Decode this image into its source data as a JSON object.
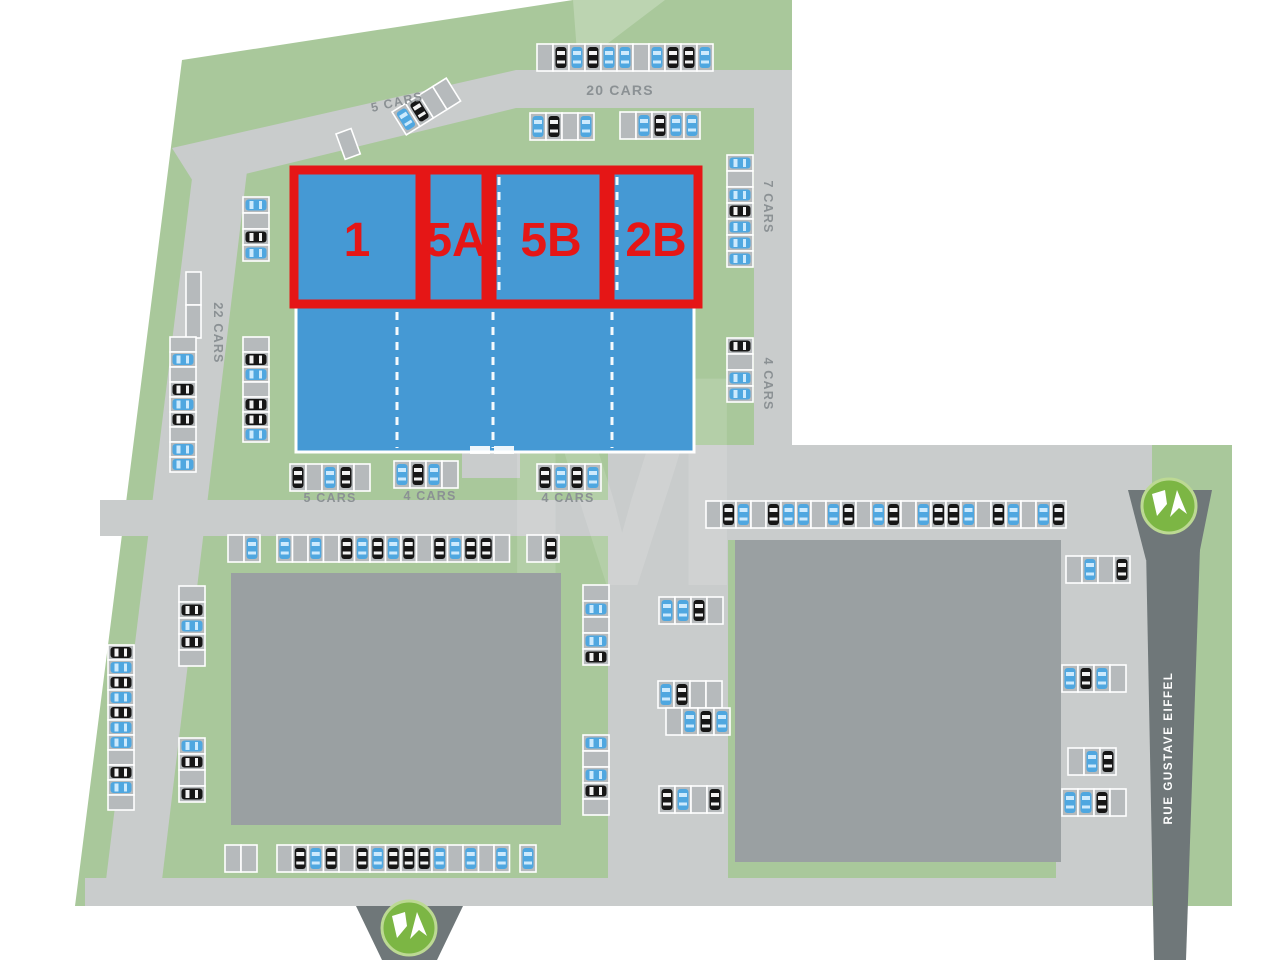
{
  "map": {
    "street_label": "RUE GUSTAVE EIFFEL",
    "watermark_letter": "M"
  },
  "units": [
    {
      "label": "1"
    },
    {
      "label": "5A"
    },
    {
      "label": "5B"
    },
    {
      "label": "2B"
    }
  ],
  "parking_area_labels": [
    {
      "text": "20 CARS",
      "x": 620,
      "y": 95,
      "angle": 0,
      "size": 14
    },
    {
      "text": "5 CARS",
      "x": 398,
      "y": 106,
      "angle": -13,
      "size": 12.5
    },
    {
      "text": "7 CARS",
      "x": 764,
      "y": 207,
      "angle": 90,
      "size": 12.5
    },
    {
      "text": "22 CARS",
      "x": 214,
      "y": 333,
      "angle": 90,
      "size": 12.5
    },
    {
      "text": "4 CARS",
      "x": 764,
      "y": 384,
      "angle": 90,
      "size": 12.5
    },
    {
      "text": "5 CARS",
      "x": 330,
      "y": 502,
      "angle": 0,
      "size": 12.5
    },
    {
      "text": "4 CARS",
      "x": 430,
      "y": 500,
      "angle": 0,
      "size": 12.5
    },
    {
      "text": "4 CARS",
      "x": 568,
      "y": 502,
      "angle": 0,
      "size": 12.5
    }
  ],
  "stall_legend": {
    "B": "car-blue",
    "K": "car-black",
    "E": "empty"
  },
  "parking_rows": [
    {
      "x": 537,
      "y": 44,
      "dir": "h",
      "stalls": "EKBKBBEBKKB"
    },
    {
      "x": 530,
      "y": 113,
      "dir": "h",
      "stalls": "BKEB"
    },
    {
      "x": 620,
      "y": 112,
      "dir": "h",
      "stalls": "EBKBB"
    },
    {
      "x": 392,
      "y": 112,
      "dir": "h",
      "angle": -32,
      "stalls": "BKEE"
    },
    {
      "x": 336,
      "y": 134,
      "dir": "h",
      "angle": -20,
      "stalls": "E"
    },
    {
      "x": 727,
      "y": 155,
      "dir": "v",
      "stalls": "BEBKBBB"
    },
    {
      "x": 727,
      "y": 338,
      "dir": "v",
      "stalls": "KEBB"
    },
    {
      "x": 243,
      "y": 197,
      "dir": "v",
      "stalls": "BEKB"
    },
    {
      "x": 186,
      "y": 272,
      "dir": "v",
      "w": 15,
      "h": 33,
      "stalls": "EE"
    },
    {
      "x": 170,
      "y": 337,
      "dir": "v",
      "h": 15,
      "stalls": "EBEKBKEBB"
    },
    {
      "x": 243,
      "y": 337,
      "dir": "v",
      "h": 15,
      "stalls": "EKBEKKB"
    },
    {
      "x": 290,
      "y": 464,
      "dir": "h",
      "stalls": "KEBKE"
    },
    {
      "x": 394,
      "y": 461,
      "dir": "h",
      "stalls": "BKBE"
    },
    {
      "x": 537,
      "y": 464,
      "dir": "h",
      "stalls": "KBKB"
    },
    {
      "x": 706,
      "y": 501,
      "dir": "h",
      "w": 15,
      "stalls": "EKBEKBBEBKEBKEBKKBEKBEBK"
    },
    {
      "x": 228,
      "y": 535,
      "dir": "h",
      "stalls": "EB"
    },
    {
      "x": 277,
      "y": 535,
      "dir": "h",
      "w": 15.5,
      "stalls": "BEBEKBKBKEKBKKE"
    },
    {
      "x": 527,
      "y": 535,
      "dir": "h",
      "stalls": "EK"
    },
    {
      "x": 179,
      "y": 586,
      "dir": "v",
      "stalls": "EKBKE"
    },
    {
      "x": 179,
      "y": 738,
      "dir": "v",
      "stalls": "BKEK"
    },
    {
      "x": 108,
      "y": 645,
      "dir": "v",
      "h": 15,
      "stalls": "KBKBKBBEKBE"
    },
    {
      "x": 583,
      "y": 585,
      "dir": "v",
      "stalls": "EBEBK"
    },
    {
      "x": 583,
      "y": 735,
      "dir": "v",
      "stalls": "BEBKE"
    },
    {
      "x": 659,
      "y": 597,
      "dir": "h",
      "stalls": "BBKE"
    },
    {
      "x": 658,
      "y": 681,
      "dir": "h",
      "stalls": "BKEE"
    },
    {
      "x": 666,
      "y": 708,
      "dir": "h",
      "stalls": "EBKB"
    },
    {
      "x": 659,
      "y": 786,
      "dir": "h",
      "stalls": "KBEK"
    },
    {
      "x": 1066,
      "y": 556,
      "dir": "h",
      "stalls": "EBEK"
    },
    {
      "x": 1062,
      "y": 665,
      "dir": "h",
      "stalls": "BKBE"
    },
    {
      "x": 1068,
      "y": 748,
      "dir": "h",
      "stalls": "EBK"
    },
    {
      "x": 1062,
      "y": 789,
      "dir": "h",
      "stalls": "BBKE"
    },
    {
      "x": 225,
      "y": 845,
      "dir": "h",
      "stalls": "EE"
    },
    {
      "x": 277,
      "y": 845,
      "dir": "h",
      "w": 15.5,
      "stalls": "EKBKEKBKKKBEBEB"
    },
    {
      "x": 520,
      "y": 845,
      "dir": "h",
      "stalls": "B"
    }
  ],
  "markers": [
    {
      "name": "va-logo-bottom-entrance",
      "cx": 409,
      "cy": 928
    },
    {
      "name": "va-logo-street-entrance",
      "cx": 1169,
      "cy": 506
    }
  ],
  "colors": {
    "site_green": "#a9c89b",
    "road_gray": "#c9cccc",
    "street_dark": "#6f7779",
    "building_gray": "#9aa0a2",
    "unit_blue": "#4599d4",
    "highlight_red": "#e51616",
    "logo_green": "#7cb644",
    "logo_ring": "#bcd993",
    "car_blue": "#4fa7e0",
    "car_black": "#161616",
    "stall_gray": "#b6babc",
    "label_gray": "#8b9194"
  }
}
